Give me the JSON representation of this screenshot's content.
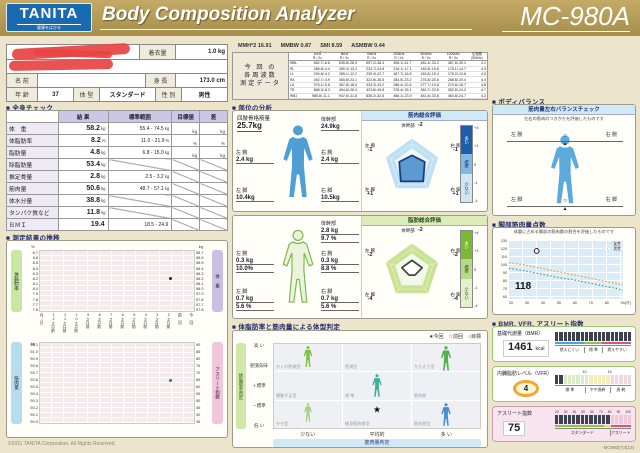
{
  "header": {
    "brand": "TANITA",
    "tagline": "健康をはかる",
    "title": "Body Composition Analyzer",
    "model": "MC-980A"
  },
  "patient": {
    "clothing_label": "着衣量",
    "clothing_value": "1.0 kg",
    "name_label": "名 前",
    "height_label": "身 長",
    "height_value": "173.0 cm",
    "age_label": "年 齢",
    "age_value": "37",
    "build_label": "体 型",
    "build_value": "スタンダード",
    "sex_label": "性 別",
    "sex_value": "男性"
  },
  "freq": {
    "stats": [
      [
        "MMH*2",
        "16.91"
      ],
      [
        "MMBW",
        "0.87"
      ],
      [
        "SMI",
        "8.59"
      ],
      [
        "ASMBW",
        "0.44"
      ]
    ],
    "side_label": [
      "今 回 の",
      "各周波数",
      "測定データ"
    ],
    "columns": [
      "1kHz",
      "5kHz",
      "50kHz",
      "250kHz",
      "500kHz",
      "1000kHz"
    ],
    "col_sub": "R / Xc",
    "phase_label": "位相角",
    "phase_sub": "(50kHz)",
    "rows": [
      [
        "WBL",
        "662.7/-8.8",
        "635.8/-28.9",
        "557.2/-38.4",
        "496.1/-41.7",
        "481.4/-33.2",
        "467.8/-30.3",
        "4.1"
      ],
      [
        "RL",
        "286.8/-4.4",
        "280.3/-13.2",
        "233.7/-24.8",
        "216.1/-17.1",
        "183.8/-15.8",
        "178.1/-14.7",
        "4.9"
      ],
      [
        "LL",
        "294.8/-4.2",
        "285.1/-12.2",
        "239.4/-22.7",
        "187.7/-16.8",
        "183.8/-15.4",
        "175.2/-13.8",
        "4.5"
      ],
      [
        "RA",
        "392.7/-4.9",
        "365.8/-23.1",
        "322.8/-36.5",
        "284.5/-23.2",
        "275.8/-20.8",
        "268.8/-20.4",
        "4.4"
      ],
      [
        "LA",
        "376.1/-5.8",
        "367.8/-18.0",
        "333.3/-34.2",
        "286.4/-22.6",
        "277.7/-19.8",
        "270.8/-18.7",
        "4.8"
      ],
      [
        "TR",
        "888.3/-8.3",
        "494.8/-26.4",
        "423.8/-49.8",
        "376.4/-25.1",
        "362.7/-23.8",
        "352.8/-24.2",
        "4.7"
      ],
      [
        "WB1",
        "985.8/-11.1",
        "947.6/-31.8",
        "836.2/-42.6",
        "466.1/-23.9",
        "481.8/-33.8",
        "463.8/-24.7",
        "4.3"
      ]
    ]
  },
  "whole_body": {
    "section_title": "■ 全身チェック",
    "headers": [
      "結 果",
      "標準範囲",
      "目標値",
      "差"
    ],
    "rows": [
      {
        "label": "体　重",
        "result": "58.2",
        "unit": "kg",
        "range": "55.4 - 74.5",
        "runit": "kg",
        "target": "kg",
        "diff": "kg"
      },
      {
        "label": "体脂肪率",
        "result": "8.2",
        "unit": "%",
        "range": "11.0 - 21.9",
        "runit": "%",
        "target": "%",
        "diff": "%"
      },
      {
        "label": "脂肪量",
        "result": "4.8",
        "unit": "kg",
        "range": "6.8 - 15.0",
        "runit": "kg",
        "target": "kg",
        "diff": "kg"
      },
      {
        "label": "除脂肪量",
        "result": "53.4",
        "unit": "kg"
      },
      {
        "label": "推定骨量",
        "result": "2.8",
        "unit": "kg",
        "range": "2.5 - 3.2",
        "runit": "kg"
      },
      {
        "label": "筋肉量",
        "result": "50.6",
        "unit": "kg",
        "range": "48.7 - 57.1",
        "runit": "kg"
      },
      {
        "label": "体水分量",
        "result": "38.8",
        "unit": "kg"
      },
      {
        "label": "タンパク質など",
        "result": "11.8",
        "unit": "kg"
      },
      {
        "label": "ＢＭＩ",
        "result": "19.4",
        "unit": "",
        "range": "18.5 - 24.9",
        "runit": ""
      }
    ]
  },
  "segmental": {
    "section_title": "■ 部位の分析",
    "muscle": {
      "mass_label": "四肢骨格筋量",
      "mass_value": "25.7kg",
      "trunk_label": "体幹部",
      "trunk_value": "24.9kg",
      "la_label": "左 腕",
      "la_value": "2.4 kg",
      "ra_label": "右 腕",
      "ra_value": "2.4 kg",
      "ll_label": "左 脚",
      "ll_value": "10.4kg",
      "rl_label": "右 脚",
      "rl_value": "10.5kg",
      "radar_title": "筋肉総合評価",
      "radar_labels": {
        "trunk": "体幹部",
        "trunk_v": "-2",
        "ra": "右 腕",
        "ra_v": "-1",
        "rl": "右 脚",
        "rl_v": "+1",
        "ll": "左 脚",
        "ll_v": "+1",
        "la": "左 腕",
        "la_v": "-1"
      },
      "legend": {
        "high": "多い",
        "mid": "標準",
        "low": "少ない",
        "t4": "+4",
        "t1": "+1",
        "t0": "0",
        "tm1": "-1",
        "tm4": "-4"
      }
    },
    "fat": {
      "trunk_label": "体幹部",
      "trunk_kg": "2.8 kg",
      "trunk_pct": "9.7 %",
      "la_label": "左 腕",
      "la_kg": "0.3 kg",
      "la_pct": "10.0%",
      "ra_label": "右 腕",
      "ra_kg": "0.3 kg",
      "ra_pct": "8.8 %",
      "ll_label": "左 脚",
      "ll_kg": "0.7 kg",
      "ll_pct": "5.6 %",
      "rl_label": "右 脚",
      "rl_kg": "0.7 kg",
      "rl_pct": "5.6 %",
      "radar_title": "脂肪総合評価",
      "radar_labels": {
        "trunk": "体幹部",
        "trunk_v": "-2",
        "ra": "右 腕",
        "ra_v": "-2",
        "rl": "右 脚",
        "rl_v": "-4",
        "ll": "左 脚",
        "ll_v": "-4",
        "la": "左 腕",
        "la_v": "-2"
      },
      "legend": {
        "high": "多い",
        "mid": "標準",
        "low": "少ない",
        "t4": "+4",
        "t1": "+1",
        "t0": "0",
        "tm1": "-1",
        "tm4": "-4"
      }
    }
  },
  "body_type": {
    "section_title": "■ 体脂肪率と筋肉量による体型判定",
    "legend": "★今回　☆前回　○目標",
    "y_axis": "体脂肪率判定",
    "y_labels": [
      "高 い",
      "肥満気味",
      "＋標準",
      "－標準",
      "低 い"
    ],
    "x_labels": [
      "少ない",
      "平均的",
      "多 い"
    ],
    "x_axis": "筋肉量判定",
    "cells": [
      [
        "かくれ肥満型",
        "肥満型",
        "かた太り型"
      ],
      [
        "運動不足型",
        "標 準",
        "筋肉質"
      ],
      [
        "やせ型",
        "細身筋肉質型",
        "筋肉質型"
      ]
    ],
    "marker": "★",
    "marker_row": 2,
    "marker_col": 1
  },
  "balance": {
    "section_title": "■ ボディバランス",
    "panel_title": "筋肉量左右バランスチェック",
    "subtitle": "左右の筋肉のつきかたを評価したものです",
    "la": "左 腕",
    "ra": "右 腕",
    "ll": "左 脚",
    "rl": "右 脚"
  },
  "leg_score": {
    "section_title": "■ 脚部筋肉量点数",
    "subtitle": "体重に占める脚部の筋肉量の割合を評価したものです",
    "value": "118",
    "legend_f": "女性",
    "legend_m": "男性",
    "x_unit": "(才)"
  },
  "indices": {
    "section_title": "■ BMR, VFR, アスリート指数",
    "bmr": {
      "label": "基礎代謝量（BMR）",
      "value": "1461",
      "unit": "kcal",
      "zones": [
        "燃えにくい",
        "標 準",
        "燃えやすい"
      ]
    },
    "vfr": {
      "label": "内臓脂肪レベル（VFR）",
      "value": "4",
      "tick1": "10",
      "tick2": "15",
      "zones": [
        "標 準",
        "やや過剰",
        "過 剰"
      ]
    },
    "athlete": {
      "label": "アスリート指数",
      "value": "75",
      "ticks": [
        "20",
        "30",
        "40",
        "50",
        "60",
        "70",
        "80",
        "90",
        "100"
      ],
      "zones": [
        "スタンダード",
        "アスリート"
      ]
    }
  },
  "history": {
    "section_title": "■ 測定結果の推移",
    "fat_axis": "体脂肪率",
    "fat_unit": "%",
    "weight_axis": "体 重",
    "weight_unit": "kg",
    "muscle_axis": "筋肉量",
    "muscle_unit": "kg",
    "athlete_axis": "アスリート指数",
    "fat_ticks": [
      "8.7",
      "8.6",
      "8.5",
      "8.4",
      "8.3",
      "8.2",
      "8.1",
      "8.0",
      "7.9",
      "7.8",
      "7.7",
      "7.6"
    ],
    "weight_ticks": [
      "58.7",
      "58.6",
      "58.5",
      "58.4",
      "58.3",
      "58.2",
      "58.1",
      "58.0",
      "57.9",
      "57.8",
      "57.7",
      "57.6"
    ],
    "muscle_ticks": [
      "51.1",
      "51.0",
      "50.9",
      "50.8",
      "50.7",
      "50.6",
      "50.5",
      "50.4",
      "50.3",
      "50.2",
      "50.1",
      "50.0"
    ],
    "athlete_ticks": [
      "90",
      "85",
      "80",
      "75",
      "70",
      "65",
      "60",
      "55",
      "50",
      "45",
      "40",
      "35"
    ],
    "x_labels": [
      "月/日",
      "12ヶ月前",
      "11ヶ月前",
      "10ヶ月前",
      "9ヶ月前",
      "8ヶ月前",
      "7ヶ月前",
      "6ヶ月前",
      "5ヶ月前",
      "4ヶ月前",
      "3ヶ月前",
      "2ヶ月前",
      "前 回",
      "今 回"
    ]
  },
  "footer": {
    "copyright": "©2011 TANITA Corporation. All Rights Reserved.",
    "code": "MC980(7)4(13)"
  },
  "colors": {
    "header_gold": "#b39955",
    "tanita_blue": "#1a6ab2",
    "muscle_blue": "#4f9fd4",
    "fat_green": "#a5ce62",
    "radar_blue_fill": "#4a90cc",
    "radar_green_bg": "#c9e293",
    "gauge_dark": "#3c4250",
    "zone_blue": "#46a4dc",
    "zone_green": "#8bc34a",
    "zone_yellow": "#f0dc6a",
    "zone_red": "#cf5a78",
    "vfr_ring_orange": "#f0a830"
  },
  "chart_data": [
    {
      "type": "radar",
      "title": "筋肉総合評価",
      "axes": [
        "体幹部",
        "右腕",
        "右脚",
        "左脚",
        "左腕"
      ],
      "values": [
        -2,
        -1,
        1,
        1,
        -1
      ],
      "scale_min": -4,
      "scale_max": 4,
      "legend": [
        "多い",
        "標準",
        "少ない"
      ]
    },
    {
      "type": "radar",
      "title": "脂肪総合評価",
      "axes": [
        "体幹部",
        "右腕",
        "右脚",
        "左脚",
        "左腕"
      ],
      "values": [
        -2,
        -2,
        -4,
        -4,
        -2
      ],
      "scale_min": -4,
      "scale_max": 4,
      "legend": [
        "多い",
        "標準",
        "少ない"
      ]
    },
    {
      "type": "line",
      "title": "脚部筋肉量点数",
      "xlabel": "年齢(才)",
      "ylim": [
        60,
        130
      ],
      "x": [
        20,
        30,
        40,
        50,
        60,
        70,
        80,
        90
      ],
      "series": [
        {
          "name": "女性",
          "values": [
            104,
            101,
            97,
            93,
            89,
            85,
            81,
            77
          ]
        },
        {
          "name": "男性",
          "values": [
            97,
            94,
            90,
            86,
            83,
            79,
            75,
            71
          ]
        }
      ],
      "marker": {
        "x": 37,
        "y": 118,
        "label": "118"
      },
      "legend_position": "top-right"
    },
    {
      "type": "scatter",
      "title": "測定結果の推移",
      "x_categories": [
        "12ヶ月前",
        "11ヶ月前",
        "10ヶ月前",
        "9ヶ月前",
        "8ヶ月前",
        "7ヶ月前",
        "6ヶ月前",
        "5ヶ月前",
        "4ヶ月前",
        "3ヶ月前",
        "2ヶ月前",
        "前回",
        "今回"
      ],
      "points": [
        {
          "series": "体脂肪率",
          "x": "今回",
          "y": 8.2
        },
        {
          "series": "筋肉量",
          "x": "今回",
          "y": 50.6
        }
      ],
      "fat_ylim": [
        7.6,
        8.7
      ],
      "muscle_ylim": [
        50.0,
        51.1
      ]
    },
    {
      "type": "gauge",
      "items": [
        {
          "label": "基礎代謝量（BMR）",
          "value": 1461,
          "unit": "kcal",
          "zones": [
            "燃えにくい",
            "標準",
            "燃えやすい"
          ]
        },
        {
          "label": "内臓脂肪レベル（VFR）",
          "value": 4,
          "scale_ticks": [
            10,
            15
          ],
          "zones": [
            "標準",
            "やや過剰",
            "過剰"
          ]
        },
        {
          "label": "アスリート指数",
          "value": 75,
          "scale": [
            20,
            100
          ],
          "zones": [
            "スタンダード",
            "アスリート"
          ]
        }
      ]
    }
  ]
}
